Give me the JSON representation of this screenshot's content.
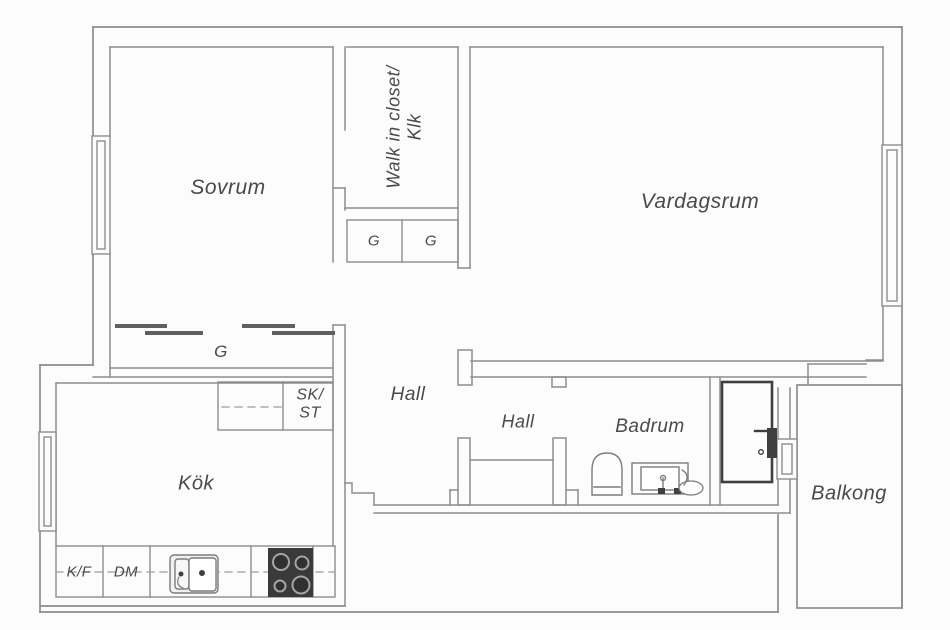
{
  "canvas": {
    "width": 950,
    "height": 630,
    "background": "#fcfcfc"
  },
  "palette": {
    "wall": "#8d8d8d",
    "furniture": "#7c7c7c",
    "dark": "#3f3f3f",
    "text": "#4a4a4a",
    "stove_body": "#3a3a3a",
    "sliding_door": "#5f5f5f"
  },
  "rooms": {
    "sovrum": {
      "label": "Sovrum"
    },
    "vardagsrum": {
      "label": "Vardagsrum"
    },
    "walk_in_closet": {
      "label_line1": "Walk in closet/",
      "label_line2": "Klk"
    },
    "hall_outer": {
      "label": "Hall"
    },
    "hall_inner": {
      "label": "Hall"
    },
    "kok": {
      "label": "Kök"
    },
    "badrum": {
      "label": "Badrum"
    },
    "balkong": {
      "label": "Balkong"
    }
  },
  "storage": {
    "wardrobe_g": {
      "label": "G"
    },
    "cabinet_g_left": {
      "label": "G"
    },
    "cabinet_g_right": {
      "label": "G"
    },
    "cabinet_sk_st": {
      "label_line1": "SK/",
      "label_line2": "ST"
    }
  },
  "appliances": {
    "fridge_freezer": {
      "label": "K/F"
    },
    "dishwasher": {
      "label": "DM"
    }
  }
}
